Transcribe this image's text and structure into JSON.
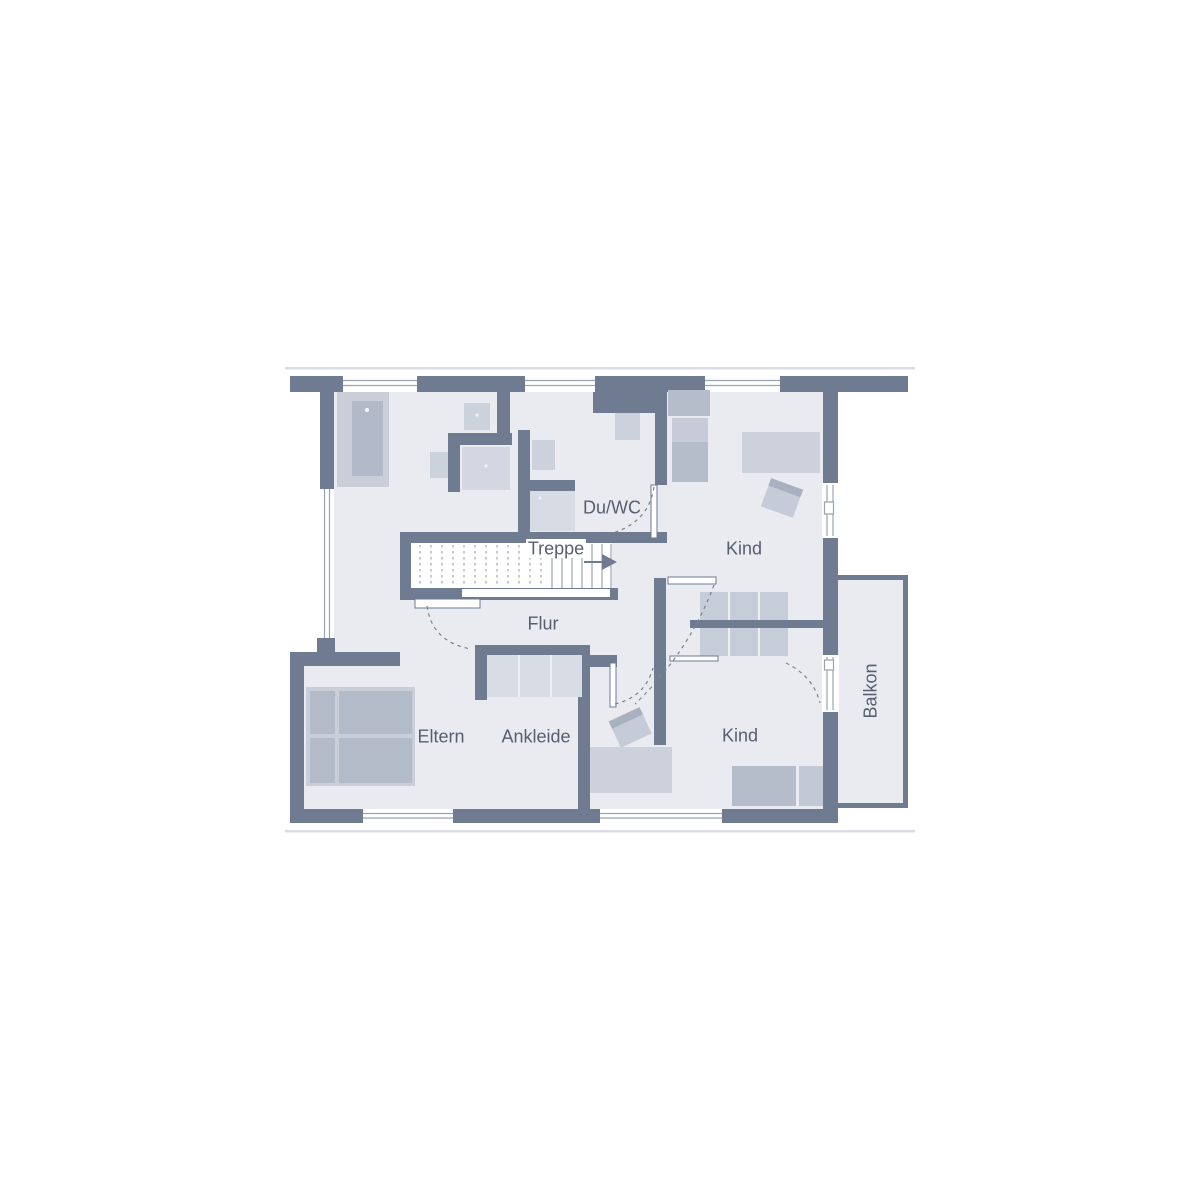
{
  "plan": {
    "title": "Obergeschoss Grundriss",
    "labels": {
      "bath_wc": "Du/WC",
      "stairs": "Treppe",
      "kid_room_top": "Kind",
      "hallway": "Flur",
      "parents_room": "Eltern",
      "dressing_room": "Ankleide",
      "kid_room_bottom": "Kind",
      "balcony": "Balkon"
    },
    "colors": {
      "wall": "#6f7b90",
      "floor": "#e9ebf1",
      "furniture_light": "#d3d8e1",
      "furniture_mid": "#c6ccd7",
      "furniture_dark": "#b4bbc9",
      "window_line": "#99a2b1",
      "text": "#565f70",
      "faint_line": "#d9dce2"
    }
  }
}
